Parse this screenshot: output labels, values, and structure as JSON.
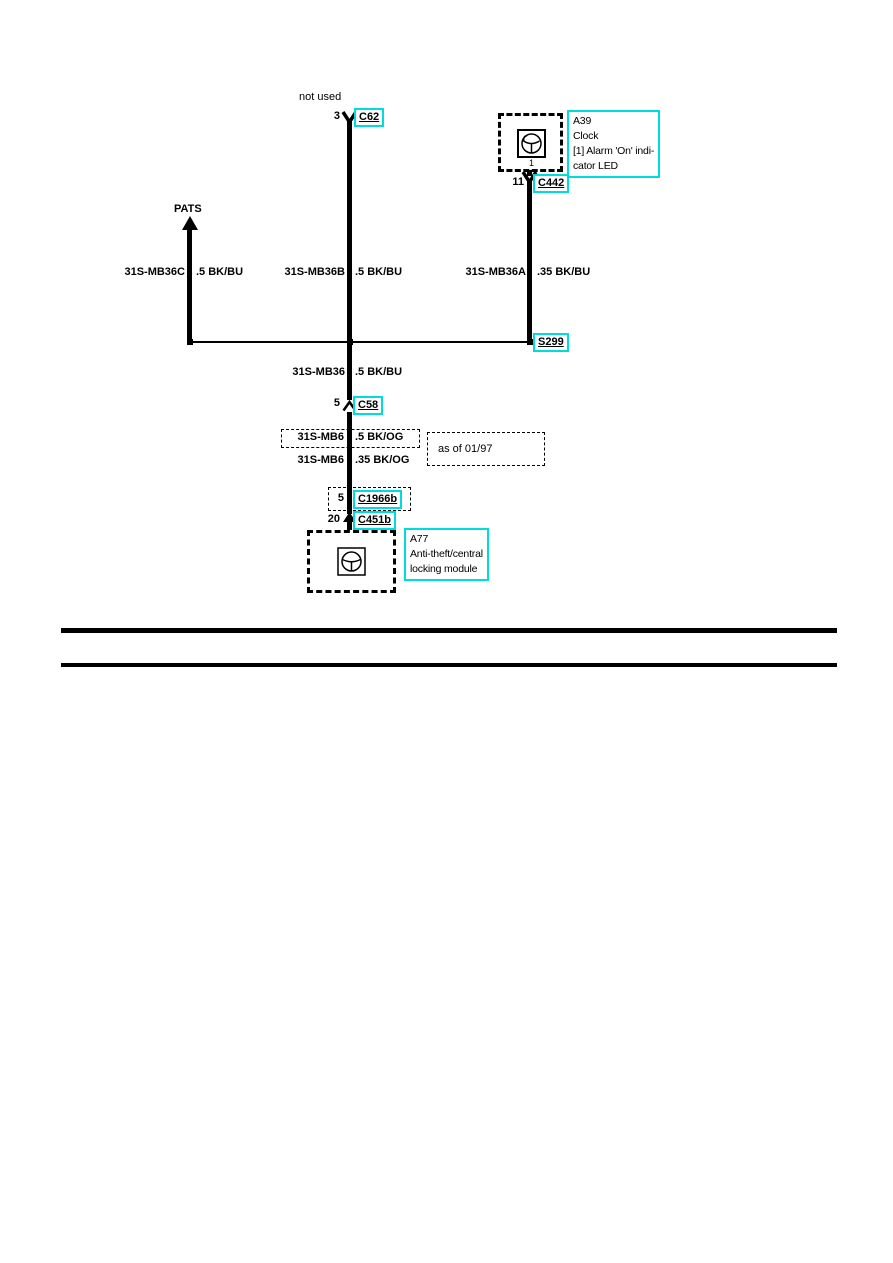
{
  "colors": {
    "highlight": "#00dcdc",
    "line": "#000000"
  },
  "annotations": {
    "not_used": "not used",
    "pats": "PATS",
    "as_of": "as of 01/97"
  },
  "connectors": {
    "c62": {
      "pin": "3",
      "label": "C62"
    },
    "c442": {
      "pin": "11",
      "label": "C442"
    },
    "s299": {
      "label": "S299"
    },
    "c58": {
      "pin": "5",
      "label": "C58"
    },
    "c1966b": {
      "pin": "5",
      "label": "C1966b"
    },
    "c451b": {
      "pin": "20",
      "label": "C451b"
    }
  },
  "components": {
    "a39": {
      "id": "A39",
      "name": "Clock",
      "note1": "[1] Alarm 'On' indi-",
      "note2": "cator LED",
      "pin": "1"
    },
    "a77": {
      "id": "A77",
      "name1": "Anti-theft/central",
      "name2": "locking module"
    }
  },
  "wires": {
    "mb36c": {
      "name": "31S-MB36C",
      "gauge": ".5 BK/BU"
    },
    "mb36b": {
      "name": "31S-MB36B",
      "gauge": ".5 BK/BU"
    },
    "mb36a": {
      "name": "31S-MB36A",
      "gauge": ".35 BK/BU"
    },
    "mb36": {
      "name": "31S-MB36",
      "gauge": ".5 BK/BU"
    },
    "mb6_boxed": {
      "name": "31S-MB6",
      "gauge": ".5 BK/OG"
    },
    "mb6_plain": {
      "name": "31S-MB6",
      "gauge": ".35 BK/OG"
    }
  }
}
